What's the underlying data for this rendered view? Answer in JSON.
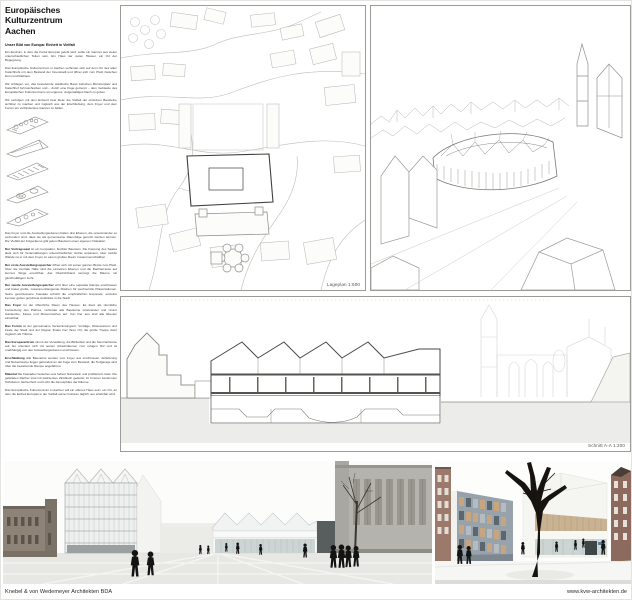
{
  "header": {
    "title_line1": "Europäisches Kulturzentrum",
    "title_line2": "Aachen",
    "subtitle": "Unser Bild von Europa: Einheit in Vielfalt"
  },
  "intro_paragraphs": [
    {
      "lead": "",
      "text": "Ein Zentrum, in dem die Kultur Europas gelebt wird, sollte ein Ganzes aus vielen unterschiedlichen Teilen sein. Ein Haus der vielen Häuser, ein Ort der Begegnung."
    },
    {
      "lead": "",
      "text": "Das Europäische Kulturzentrum in Aachen verbindet sich auf dem Ort des alten Katschhofs mit dem Bestand der Innenstadt und öffnet sich zum Platz zwischen Dom und Rathaus."
    },
    {
      "lead": "",
      "text": "Wir schlagen vor, das bestehende städtische Band zwischen Münsterplatz und Katschhof fortzuschreiben und – durch eine Fuge getrennt – dem Gebäude des Europäischen Kulturzentrums ein eigenes, vielgestaltiges Dach zu geben."
    },
    {
      "lead": "",
      "text": "Wir verfolgen mit dem Entwurf zwei Ziele: die Vielfalt der einzelnen Bausteine sichtbar zu machen und zugleich aus der Erschließung, dem Foyer und dem Forum ein verbindendes Ganzes zu bilden."
    }
  ],
  "body_paragraphs": [
    {
      "lead": "",
      "text": "Das Foyer und die Ausstellungsebenen bilden drei Ebenen, die untereinander so verbunden sind, dass sie als gemeinsame Raumfolge genutzt werden können. Die Vielfalt der Folgeräume gibt jedem Baustein einen eigenen Charakter."
    },
    {
      "lead": "Der Vortragssaal",
      "text": "ist ein kompakter, flexibler Baustein. Die Fassung des Saales lässt sich für Veranstaltungen unterschiedlicher Größe anpassen; über mobile Wände ist er mit dem Foyer zu einem großen Raum zusammenschaltbar."
    },
    {
      "lead": "Der erste Ausstellungsspeicher",
      "text": "öffnet sich mit seiner ganzen Breite zum Platz. Über die zentrale Halle sind die einzelnen Ebenen und die Dachterrasse auf kurzem Wege erreichbar; das Oberlichtband versorgt die Räume mit gleichmäßigem Licht."
    },
    {
      "lead": "Der zweite Ausstellungsspeicher",
      "text": "wird über eine separate Rampe erschlossen und bietet große, zusammenhängende Flächen für wechselnde Präsentationen. Seine geschlossene Fassade schützt die empfindlichen Exponate; einzelne Fenster geben gerichtete Ausblicke in die Stadt."
    },
    {
      "lead": "Das Foyer",
      "text": "ist der öffentliche Raum des Hauses. Es dient als räumliche Fortsetzung des Platzes, verbindet alle Bausteine miteinander und nimmt Garderobe, Kasse und Museumsshop auf. Von hier aus sind alle Ebenen einsehbar."
    },
    {
      "lead": "Das Forum",
      "text": "ist der gemeinsame Versammlungsort. Vorträge, Diskussionen und Feste der Stadt und der Region finden hier ihren Ort; die große Treppe dient zugleich als Tribüne."
    },
    {
      "lead": "Das Europazentrum",
      "text": "nimmt die Verwaltung, die Bibliothek und die Seminarräume auf. Es orientiert sich mit seinen Arbeitsräumen zum ruhigen Hof und ist unabhängig von den Ausstellungsebenen erschlossen."
    },
    {
      "lead": "Erschließung",
      "text": "Alle Bausteine werden vom Foyer aus erschlossen. Anlieferung und Nebenräume liegen gebündelt an der Fuge zum Bestand; die Tiefgarage wird über die bestehende Rampe angefahren."
    },
    {
      "lead": "Material",
      "text": "Die Fassaden bestehen aus hellem Naturstein und profiliertem Glas. Die gefalteten Dächer sind mit patiniertem Zinkblech gedeckt; im Inneren bestimmen Sichtbeton, Eichenholz und Licht die Atmosphäre der Räume."
    },
    {
      "lead": "",
      "text": "Das Europäische Kulturzentrum in Aachen will ein offenes Haus sein: ein Ort, an dem die Einheit Europas in der Vielfalt seiner Kulturen täglich neu erfahrbar wird."
    }
  ],
  "captions": {
    "site_plan": "Lageplan 1:500",
    "section": "Schnitt A-A 1:200"
  },
  "footer": {
    "studio": "Knebel & von Wedemeyer Architekten BDA",
    "website": "www.kvw-architekten.de"
  },
  "colors": {
    "panel_border": "#9b9b97",
    "line_work": "#9a9a96",
    "ground_gray": "#ecedea",
    "historic_masonry": "#8d8376",
    "town_hall_gray": "#b5b3ae",
    "brick": "#9b7a6c",
    "slab_gray": "#97a2aa",
    "beige_band": "#c8b292",
    "glass": "#cdd4d4",
    "people_silhouette": "#141414"
  }
}
